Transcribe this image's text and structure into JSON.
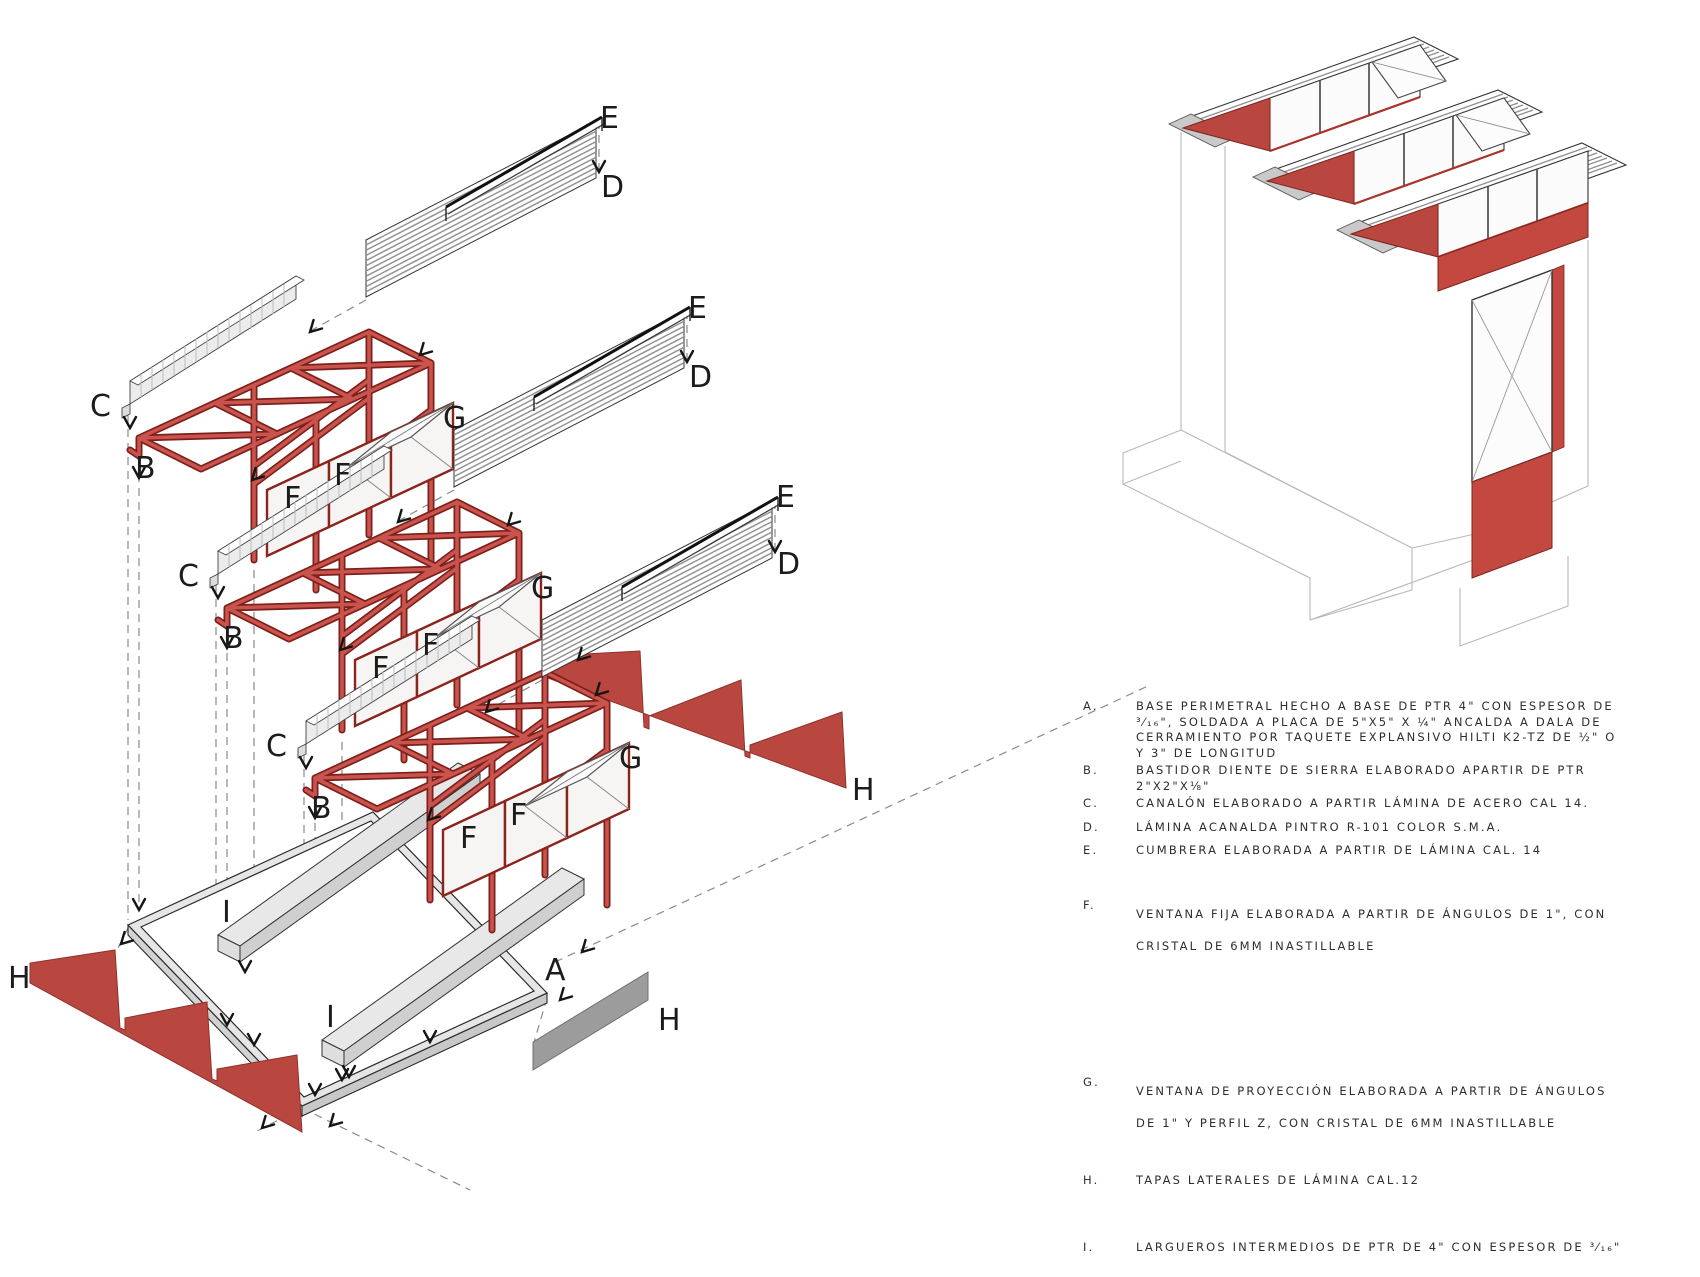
{
  "colors": {
    "accent_red": "#b9473f",
    "truss_red": "#c9544d",
    "truss_red_dark": "#7d1f1a",
    "window_frame_red": "#8c241e",
    "light_gray": "#e8e8e8",
    "mid_gray": "#9c9c9c",
    "stripe_gray": "#8f8f8f",
    "wireframe_gray": "#b8b8b8",
    "ink": "#1c1c1c"
  },
  "letters": {
    "A": "A",
    "B": "B",
    "C": "C",
    "D": "D",
    "E": "E",
    "F": "F",
    "G": "G",
    "H": "H",
    "I": "I"
  },
  "legend": {
    "items": [
      {
        "letter": "A.",
        "lines": [
          "BASE PERIMETRAL HECHO A BASE DE PTR 4\" CON ESPESOR DE",
          "³⁄₁₆\", SOLDADA A PLACA DE 5\"X5\" X ¼\" ANCALDA A DALA DE",
          "CERRAMIENTO POR TAQUETE EXPLANSIVO HILTI K2-TZ DE ½\" O",
          "Y 3\" DE LONGITUD"
        ]
      },
      {
        "letter": "B.",
        "lines": [
          "BASTIDOR DIENTE DE SIERRA ELABORADO APARTIR DE PTR",
          "2\"X2\"X⅛\""
        ]
      },
      {
        "letter": "C.",
        "lines": [
          "CANALÓN ELABORADO A PARTIR LÁMINA DE ACERO CAL 14."
        ]
      },
      {
        "letter": "D.",
        "lines": [
          "LÁMINA ACANALDA PINTRO R-101 COLOR S.M.A."
        ]
      },
      {
        "letter": "E.",
        "lines": [
          "CUMBRERA ELABORADA A PARTIR DE LÁMINA CAL. 14"
        ]
      },
      {
        "letter": "F.",
        "lines": [
          "VENTANA FIJA ELABORADA A PARTIR DE ÁNGULOS DE 1\", CON",
          "CRISTAL DE 6MM INASTILLABLE"
        ]
      },
      {
        "letter": "G.",
        "lines": [
          "VENTANA DE PROYECCIÓN ELABORADA A PARTIR DE ÁNGULOS",
          "DE 1\" Y PERFIL Z, CON CRISTAL DE 6MM INASTILLABLE"
        ]
      },
      {
        "letter": "H.",
        "lines": [
          "TAPAS LATERALES DE LÁMINA CAL.12"
        ]
      },
      {
        "letter": "I.",
        "lines": [
          "LARGUEROS INTERMEDIOS DE PTR DE 4\" CON ESPESOR DE ³⁄₁₆\""
        ]
      }
    ]
  }
}
